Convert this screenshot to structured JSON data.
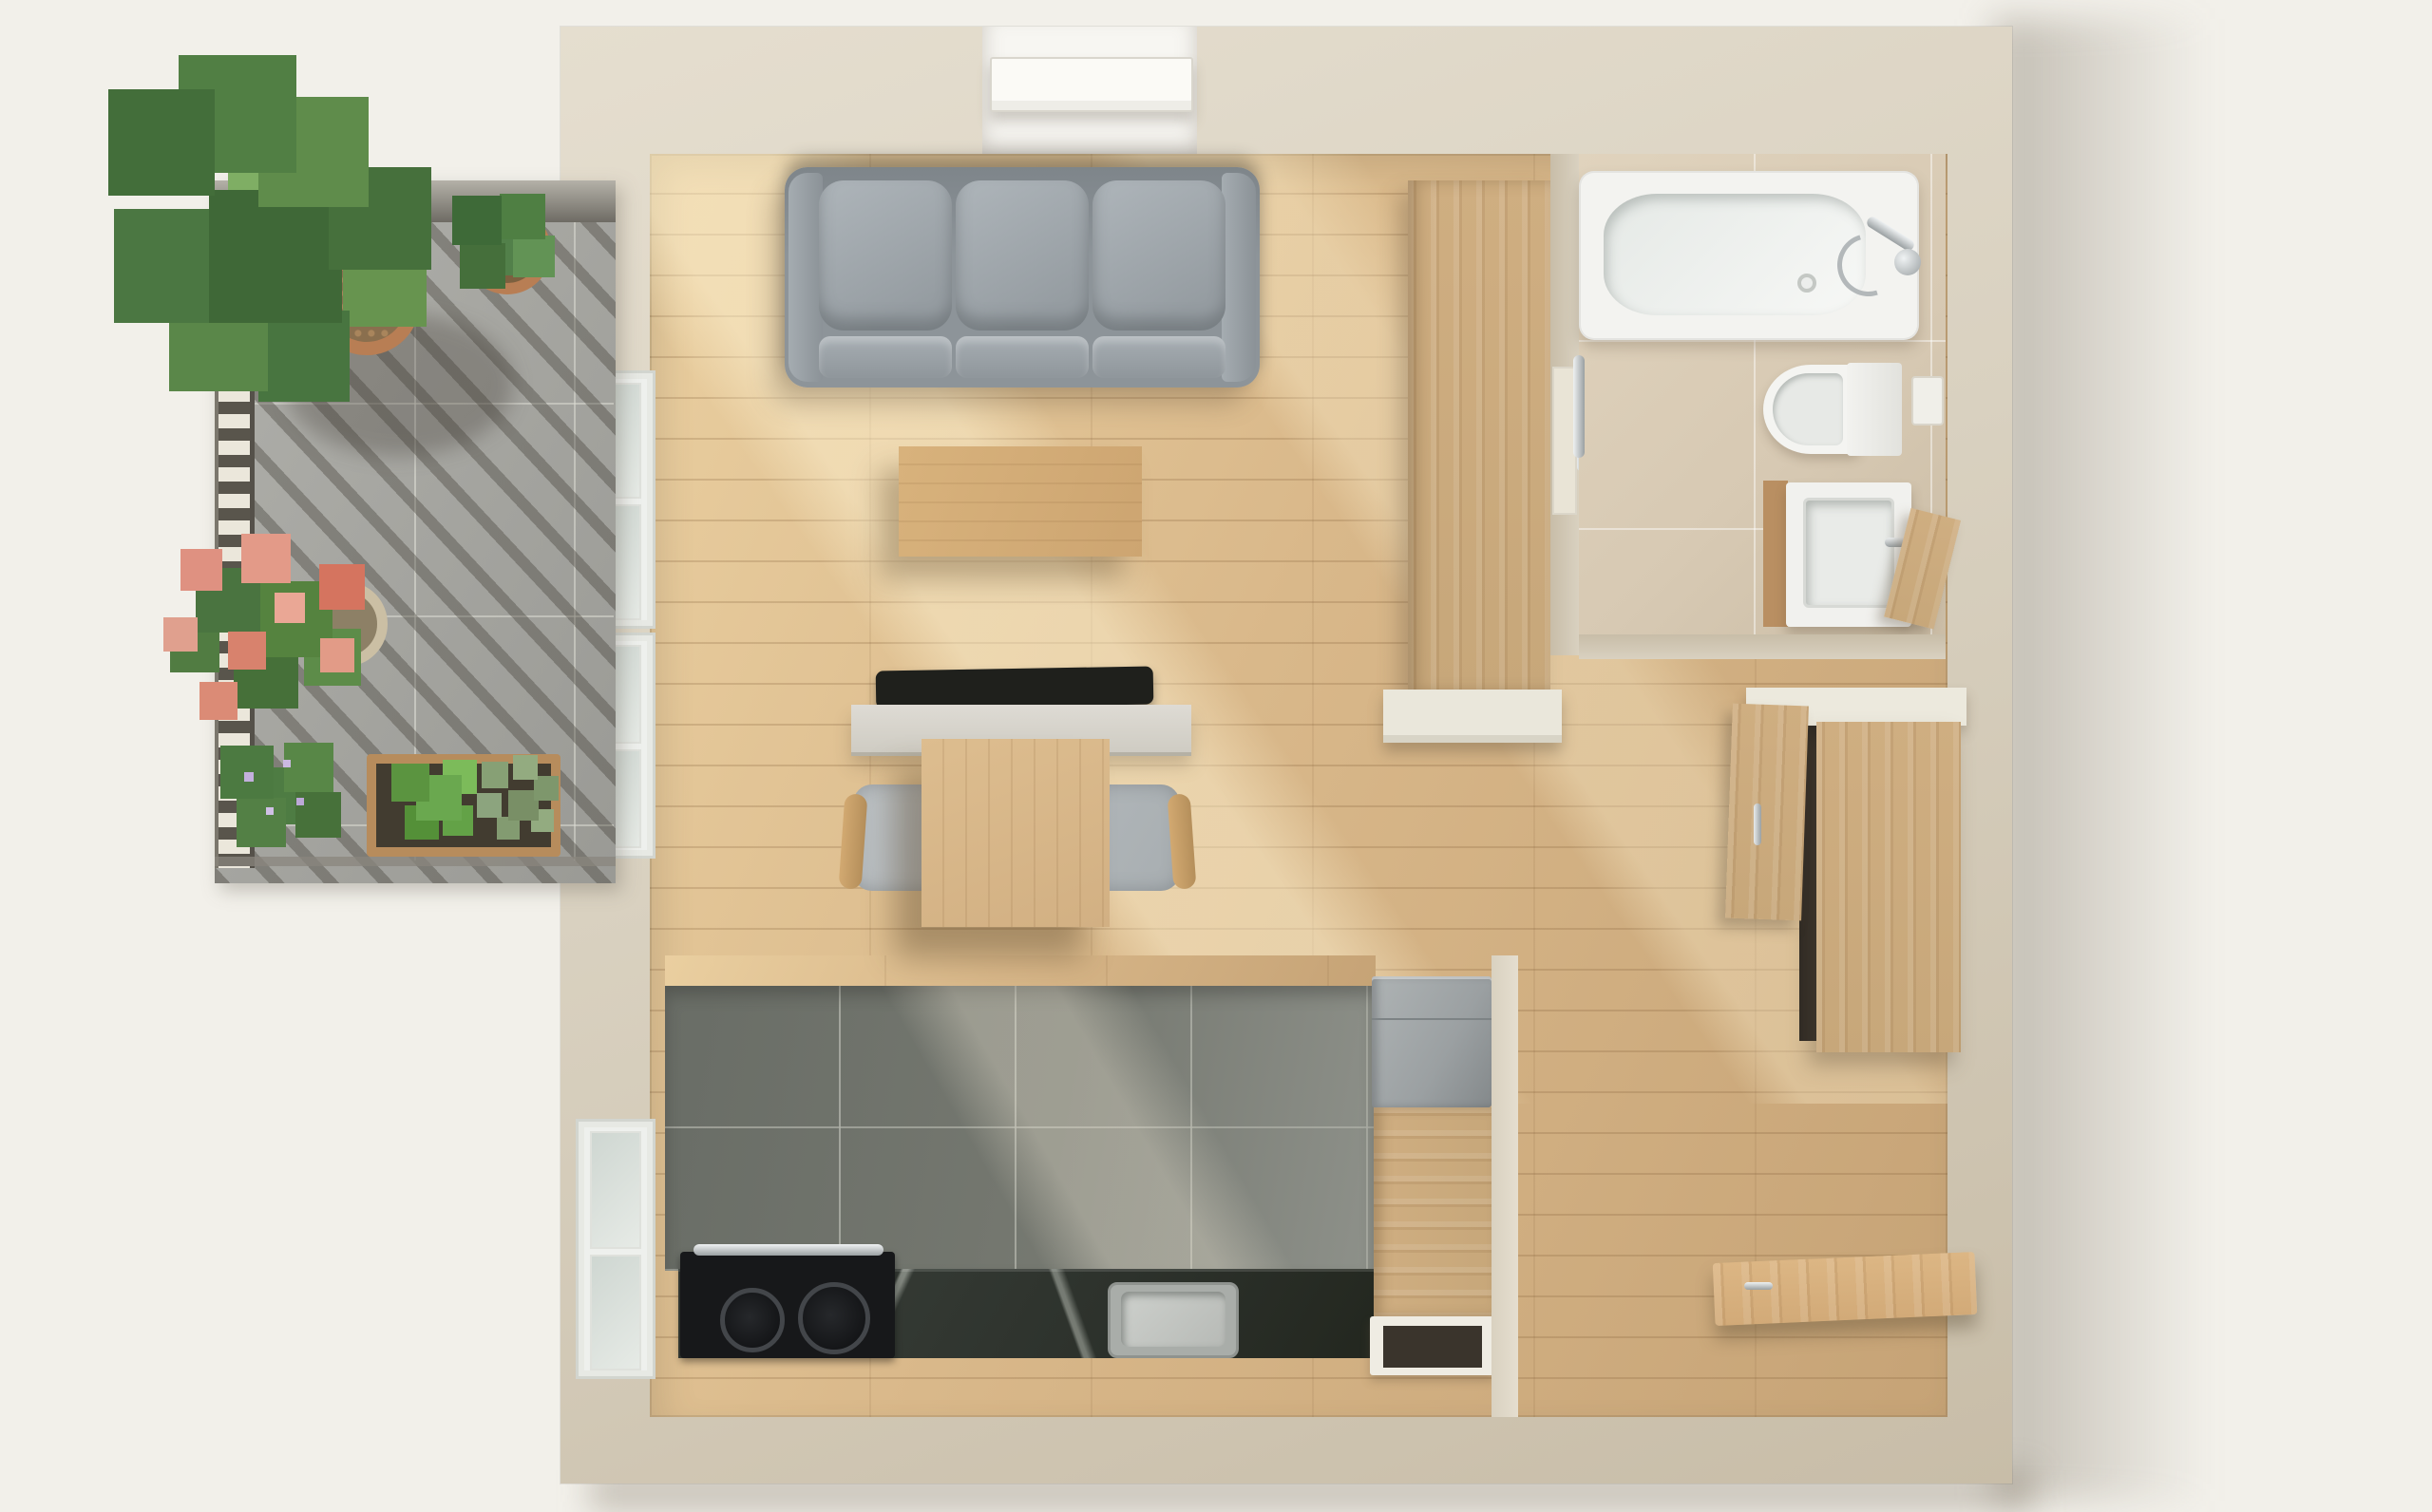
{
  "title": "studio-apartment-top-down-floor-plan-render",
  "palette": {
    "bg": "#f2f0ea",
    "wall": "#d9d1c0",
    "wallDark": "#c8bda8",
    "wallLight": "#e5decf",
    "floor": "#d9b88a",
    "floorLight": "#eacfa0",
    "floorDark": "#c6a376",
    "ktile": "#757870",
    "balTile": "#a5a5a0",
    "slat": "#ebe7db",
    "slatGap": "#59554c",
    "railBar": "#8e8b83",
    "sofaBase": "#8d9499",
    "sofaCushion": "#aeb5ba",
    "furnWood": "#cda571",
    "tableWood": "#d2b083",
    "wardrobe": "#c7a77a",
    "doorWood": "#d2aa78",
    "marble": "#2d322c",
    "fridge": "#9ba0a2",
    "terracotta": "#b87e54",
    "potStone": "#cbbfa4",
    "bathFloor": "#d7c9b3",
    "tub": "#f3f3f0",
    "chrome": "#c6cacc",
    "leafDark": "#3f6837",
    "leafMid": "#4b7742",
    "leafLight": "#67944f",
    "leafBright": "#6aa84f",
    "herbGray": "#8ca47e",
    "flowerPink": "#df9181",
    "flowerPinkDark": "#d5745f"
  },
  "items": {
    "sofa": "gray three-seat sofa",
    "coffee_table": "wooden coffee table",
    "desk": "desk with monitor",
    "dining_table": "wooden table with upholstered chair",
    "wardrobe": "tall wooden wardrobe",
    "bathtub": "bathtub with chrome mixer",
    "toilet": "wall-hung toilet",
    "vanity": "washbasin vanity with open door",
    "hall_cabinet": "hallway cabinet with open door",
    "fridge": "refrigerator",
    "cooktop": "two-burner cooktop on stone counter",
    "kitchen_sink": "square kitchen sink",
    "entry_door": "open wooden entry door",
    "balcony": "tiled balcony with pergola shade",
    "fiddle_leaf_fig": "large fiddle-leaf fig plant",
    "geraniums": "pink geraniums in stone pot",
    "herb_planter": "wooden planter with basil and rosemary",
    "windows": "white-framed balcony windows"
  }
}
